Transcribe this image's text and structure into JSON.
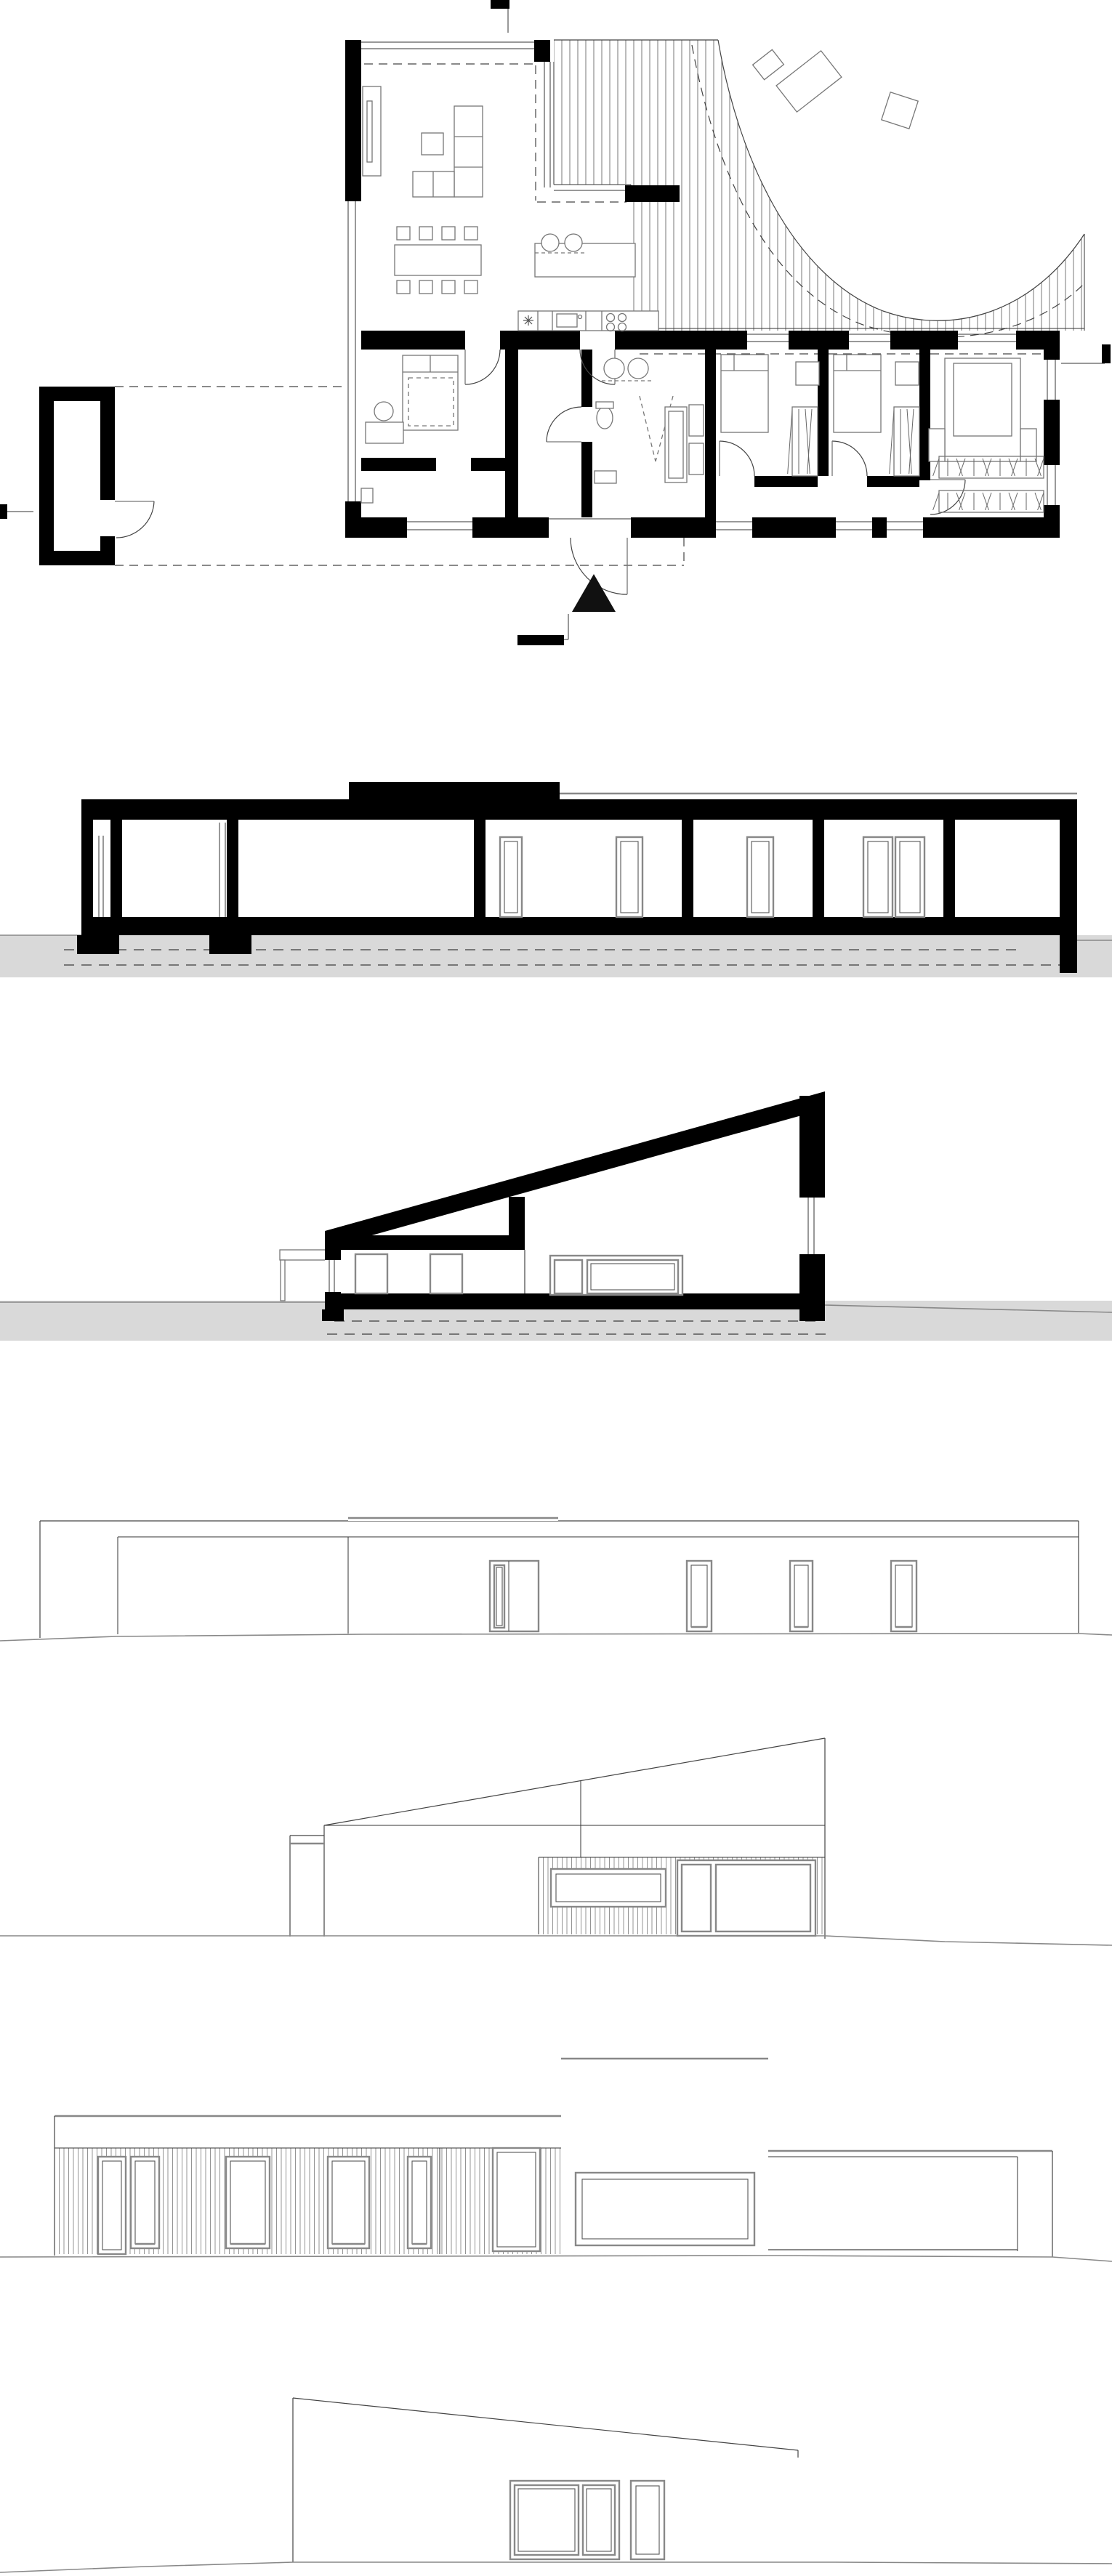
{
  "page": {
    "title": "Architectural drawing sheet - single-storey flat/mono-pitch roof house",
    "background": "#ffffff",
    "contains_text": false
  },
  "colors": {
    "wall_fill": "#000000",
    "line": "#444444",
    "furniture_line": "#777777",
    "window_frame": "#888888",
    "ground_fill": "#d9d9d9",
    "hatch_line": "#666666",
    "dashed_line": "#444444"
  },
  "panels": [
    {
      "name": "floor-plan",
      "type": "plan",
      "description": "Ground floor plan: living room with sofa and dining table, kitchen island, corridor, bathroom block, three bedrooms with wardrobes, detached storage room linked by dashed carport outline, curved timber deck terrace, north arrow and section markers"
    },
    {
      "name": "longitudinal-section",
      "type": "section",
      "description": "Long section: flat roof, raised clerestory box, room doors, black floor slab, grey ground with dashed foundation lines"
    },
    {
      "name": "cross-section",
      "type": "section",
      "description": "Cross section: mono-pitch roof rising to the right, clerestory mullion, interior doors, glazed door, grey ground"
    },
    {
      "name": "entrance-elevation",
      "type": "elevation",
      "description": "Thin-line elevation: low storage volume left, clerestory box, entrance door with sidelight, three narrow windows"
    },
    {
      "name": "gable-elevation",
      "type": "elevation",
      "description": "Elevation with mono-pitch gable, vertical board cladding band, horizontal window and glazed door"
    },
    {
      "name": "garden-elevation",
      "type": "elevation",
      "description": "Long clad facade with door and four windows, picture window, clerestory box with large window, carport opening at right"
    },
    {
      "name": "rear-elevation",
      "type": "elevation",
      "description": "Partial elevation: mono-pitch roof falling to the right, glazed door pair, narrow window, low storage volume in front"
    }
  ],
  "symbols": [
    {
      "name": "north-arrow",
      "glyph": "filled triangle"
    },
    {
      "name": "section-marker",
      "glyph": "black flag bar with tail line"
    },
    {
      "name": "deck-boards",
      "glyph": "closely spaced vertical lines"
    },
    {
      "name": "wardrobe-hatch",
      "glyph": "diagonal tick marks"
    }
  ]
}
